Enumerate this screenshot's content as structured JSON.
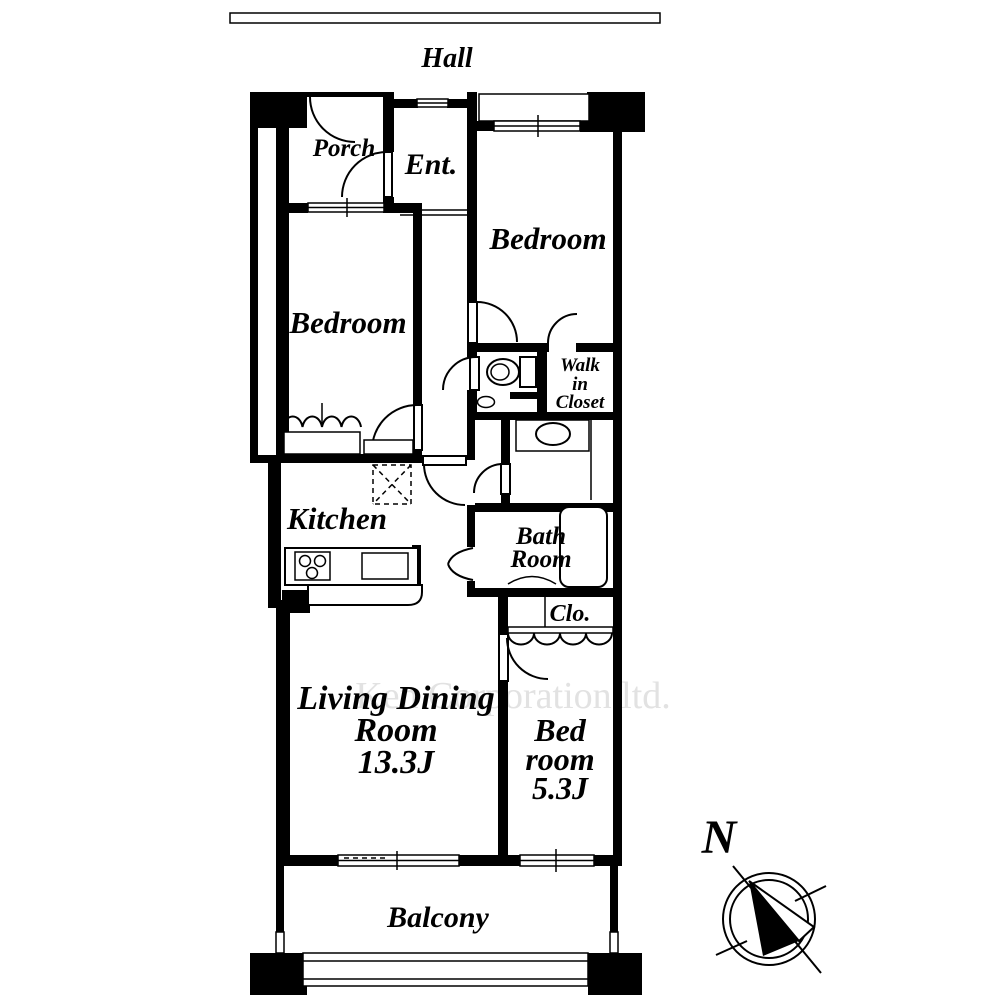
{
  "page": {
    "background": "#ffffff",
    "wall_color": "#000000",
    "watermark_color": "#e2e2e2"
  },
  "labels": {
    "hall": "Hall",
    "porch": "Porch",
    "entrance": "Ent.",
    "bedroom_top_right": "Bedroom",
    "bedroom_left": "Bedroom",
    "walk_in_closet": {
      "line1": "Walk",
      "line2": "in",
      "line3": "Closet"
    },
    "kitchen": "Kitchen",
    "bath_room": {
      "line1": "Bath",
      "line2": "Room"
    },
    "closet": "Clo.",
    "living_dining": {
      "line1": "Living Dining",
      "line2": "Room",
      "line3": "13.3J"
    },
    "bedroom_bottom_right": {
      "line1": "Bed",
      "line2": "room",
      "line3": "5.3J"
    },
    "balcony": "Balcony",
    "compass_north": "N",
    "watermark": "Ken Corporation ltd."
  }
}
